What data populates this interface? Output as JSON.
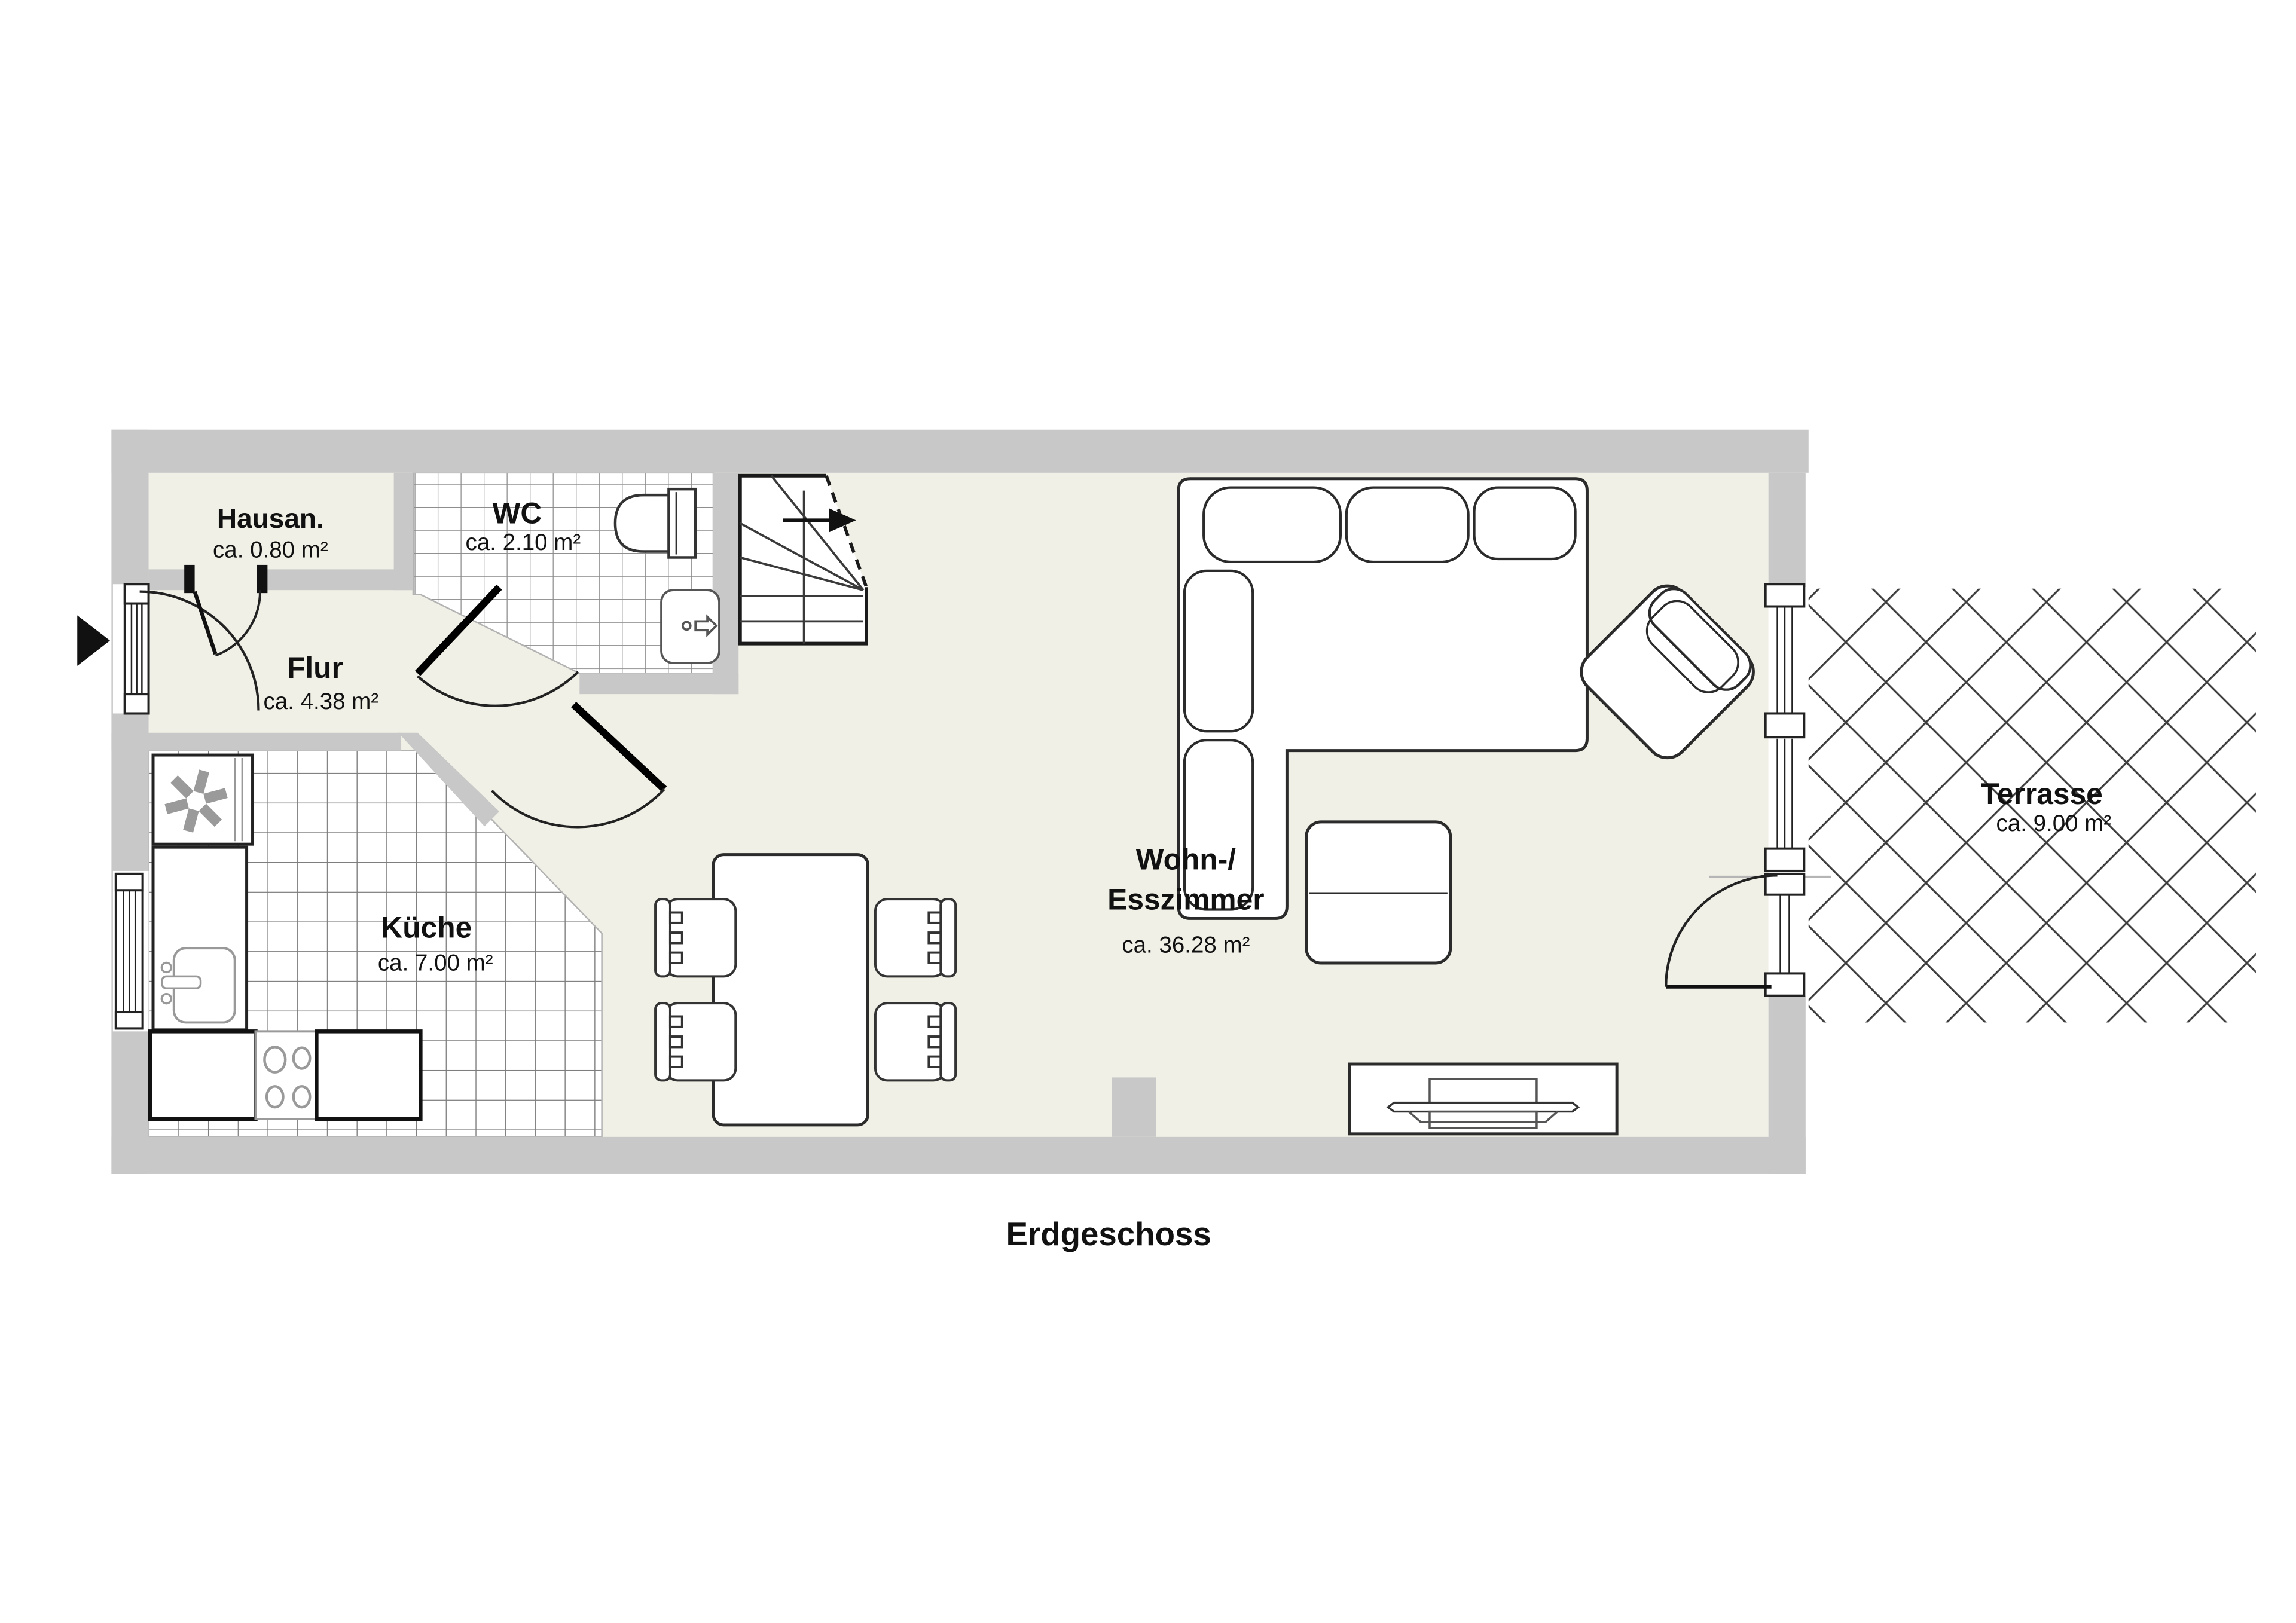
{
  "floor_plan": {
    "floor_label": "Erdgeschoss",
    "rooms": {
      "hausan": {
        "name": "Hausan.",
        "area": "ca. 0.80 m²"
      },
      "wc": {
        "name": "WC",
        "area": "ca. 2.10 m²"
      },
      "flur": {
        "name": "Flur",
        "area": "ca. 4.38 m²"
      },
      "kueche": {
        "name": "Küche",
        "area": "ca. 7.00 m²"
      },
      "wohn_esszimmer": {
        "name_line1": "Wohn-/",
        "name_line2": "Esszimmer",
        "area": "ca. 36.28 m²"
      },
      "terrasse": {
        "name": "Terrasse",
        "area": "ca. 9.00 m²"
      }
    },
    "colors": {
      "wall": "#c8c8c8",
      "floor": "#f1f0e6",
      "tile_line": "#8c8c8c",
      "outline": "#2b2b2b",
      "hatch_line": "#3d3d3d"
    }
  }
}
